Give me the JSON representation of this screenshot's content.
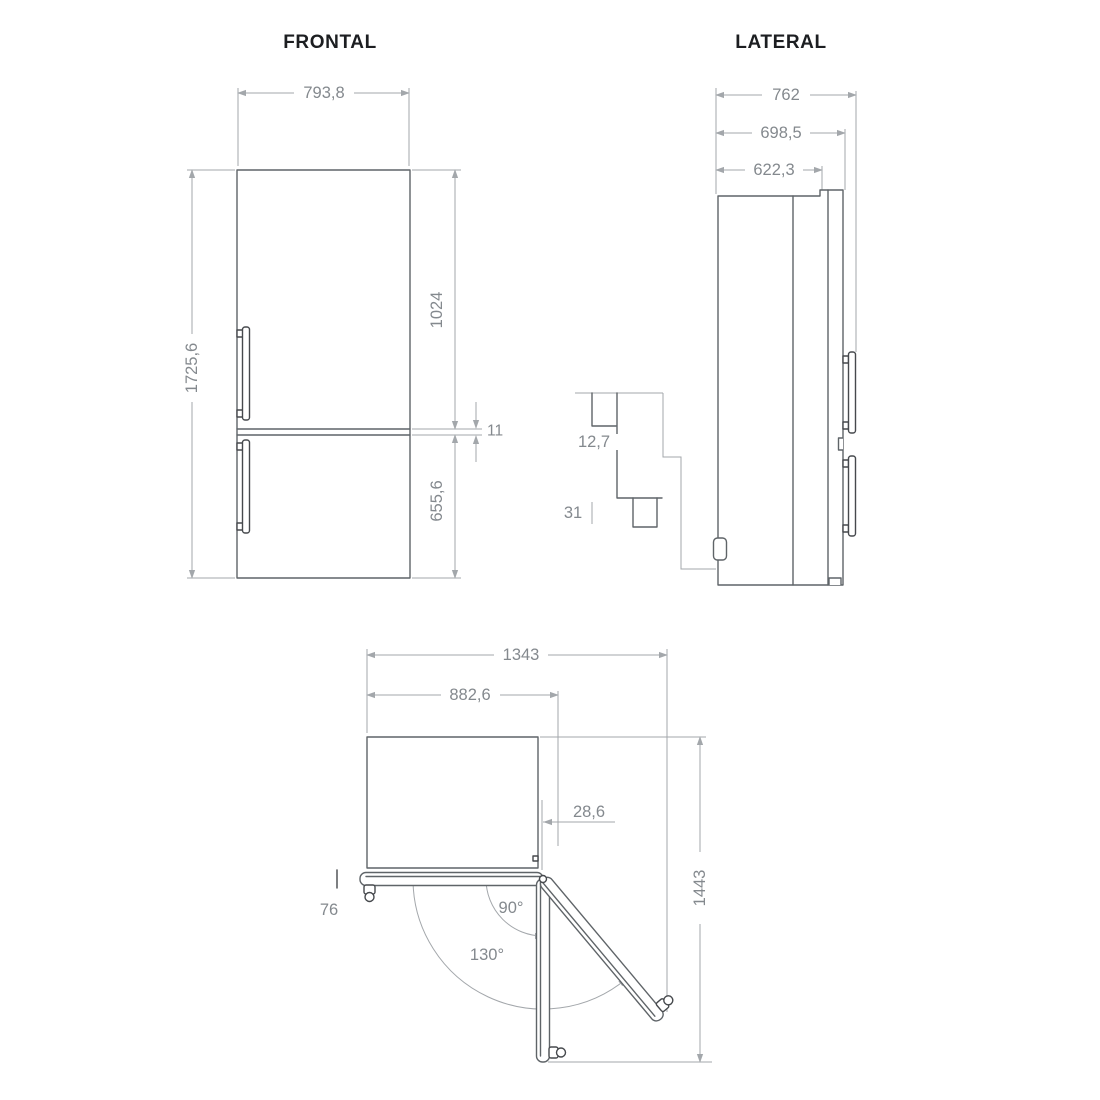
{
  "drawing_type": "refrigerator-dimension-diagram",
  "views": {
    "frontal": {
      "title": "FRONTAL",
      "dims": {
        "width": "793,8",
        "total_height": "1725,6",
        "upper_height": "1024",
        "gap": "11",
        "lower_height": "655,6"
      }
    },
    "lateral": {
      "title": "LATERAL",
      "dims": {
        "overall_depth": "762",
        "door_depth": "698,5",
        "cabinet_depth": "622,3",
        "detail_offset": "12,7",
        "detail_foot": "31"
      }
    },
    "top": {
      "dims": {
        "open_width": "1343",
        "body_width": "882,6",
        "hinge_offset": "28,6",
        "open_depth": "1443",
        "handle_clearance": "76",
        "angle_90": "90°",
        "angle_130": "130°"
      }
    }
  },
  "colors": {
    "outline": "#5f6468",
    "dim": "#a3a7ab",
    "text": "#84898e",
    "title": "#1c1e21",
    "dark": "#46494d",
    "bg": "#ffffff"
  }
}
